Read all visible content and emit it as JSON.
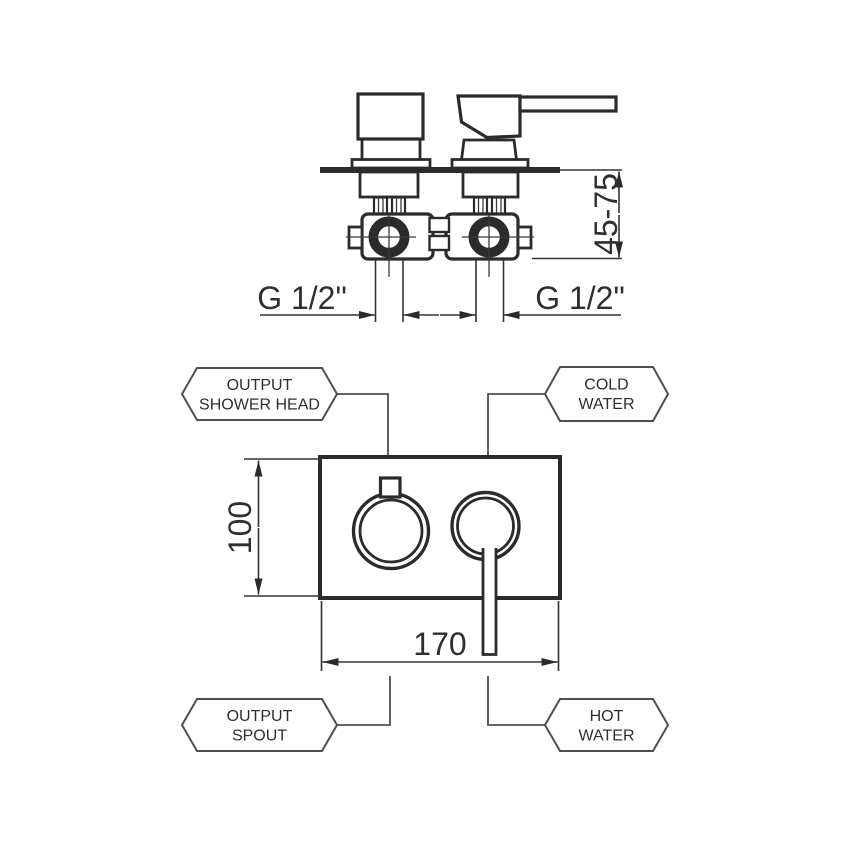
{
  "top_view": {
    "depth_range": "45-75",
    "thread_left": "G 1/2\"",
    "thread_right": "G 1/2\""
  },
  "front_view": {
    "height": "100",
    "width": "170"
  },
  "callouts": {
    "output_shower_head": {
      "line1": "OUTPUT",
      "line2": "SHOWER HEAD"
    },
    "cold_water": {
      "line1": "COLD",
      "line2": "WATER"
    },
    "output_spout": {
      "line1": "OUTPUT",
      "line2": "SPOUT"
    },
    "hot_water": {
      "line1": "HOT",
      "line2": "WATER"
    }
  },
  "colors": {
    "line": "#2b2b2b",
    "callout_line": "#4f4f4f",
    "background": "#ffffff"
  }
}
